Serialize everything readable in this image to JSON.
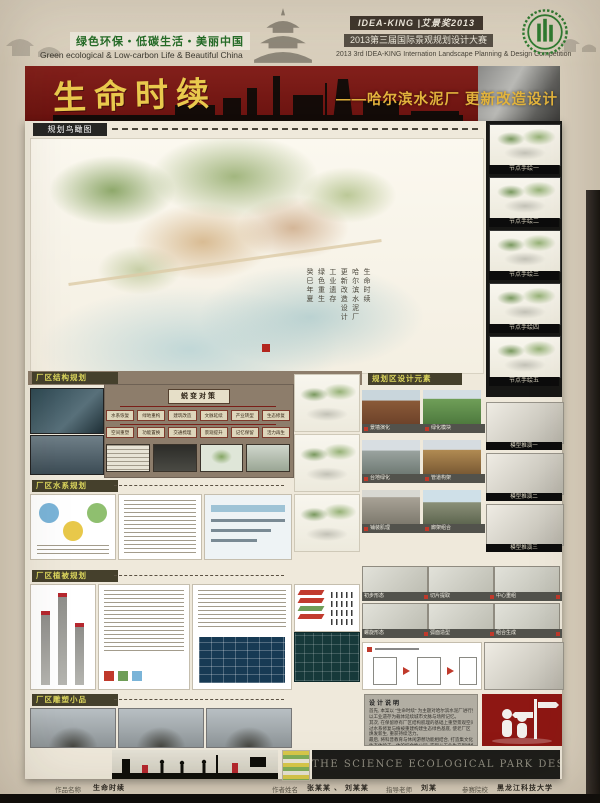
{
  "header": {
    "slogan_cn": "绿色环保・低碳生活・美丽中国",
    "slogan_en": "Green ecological & Low-carbon Life & Beautiful China",
    "brand": "IDEA-KING |艾景奖2013",
    "competition_cn": "2013第三届国际景观规划设计大赛",
    "competition_en": "2013 3rd IDEA-KING Internation Landscape Planning & Design Competition"
  },
  "banner": {
    "title": "生命时续",
    "subtitle": "——哈尔滨水泥厂 更新改造设计"
  },
  "aerial": {
    "tab": "规划鸟瞰图",
    "annotations": [
      "生命时续",
      "哈尔滨水泥厂",
      "更新改造设计",
      "工业遗存",
      "绿色重生",
      "癸巳年夏"
    ]
  },
  "node_sketches": {
    "captions": [
      "节点手绘一",
      "节点手绘二",
      "节点手绘三",
      "节点手绘四",
      "节点手绘五"
    ]
  },
  "sections": {
    "structure": "厂区结构规划",
    "elements": "规划区设计元素",
    "water": "厂区水系规划",
    "planting": "厂区植被规划",
    "sculpture": "厂区雕塑小品"
  },
  "strategy": {
    "root": "蜕变对策",
    "row1": [
      "水系恢复",
      "绿地重构",
      "建筑改造",
      "文脉延续",
      "产业转型",
      "生态修复"
    ],
    "row2": [
      "空间重塑",
      "功能置换",
      "交通梳理",
      "景观提升",
      "记忆保留",
      "活力再生"
    ]
  },
  "element_captions": [
    "景墙演化",
    "绿化模块",
    "台地绿化",
    "管道构架",
    "铺装肌理",
    "廊架组合"
  ],
  "model_captions": [
    "模型推演一",
    "模型推演二",
    "模型推演三"
  ],
  "transform_captions": [
    "初步形态",
    "切片提取",
    "中心重组",
    "螺旋形态",
    "弧面造型",
    "组合生成"
  ],
  "design_note": {
    "title": "设计说明",
    "lines": [
      "首先, 本案以 \"生命时续\" 为主题对哈尔滨水泥厂进行更新改造,",
      "以工业遗存为载体延续城市文脉与场所记忆。",
      "其次, 在保留原有厂区结构肌理的基础上重塑景观空间, 通",
      "过水系修复与植被重建构建生态绿色基底, 使老厂区",
      "焕发新生, 重获持续活力。",
      "最后, 将科普教育与休闲游憩功能相结合, 打造集文化展示,",
      "生态体验于一体的综合性公园, 实现从工业生产到绿色生活",
      "的时序延续。"
    ]
  },
  "footer_band": "THE SCIENCE ECOLOGICAL PARK DESIGN",
  "credits": {
    "work_label": "作品名称",
    "work_value": "生命时续",
    "author_label": "作者姓名",
    "author_value": "张某某 、 刘某某",
    "advisor_label": "指导老师",
    "advisor_value": "刘某",
    "school_label": "参赛院校",
    "school_value": "黑龙江科技大学"
  }
}
